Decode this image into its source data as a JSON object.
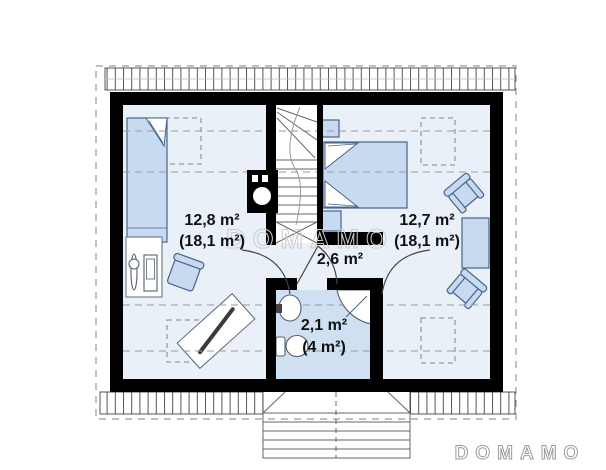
{
  "plan": {
    "title_watermark": "DOMAMO",
    "rooms": {
      "bedroom_left": {
        "area": "12,8 m²",
        "area_total": "(18,1 m²)"
      },
      "bedroom_right": {
        "area": "12,7 m²",
        "area_total": "(18,1 m²)"
      },
      "hall": {
        "area": "2,6 m²"
      },
      "bathroom": {
        "area": "2,1 m²",
        "area_total": "(4 m²)"
      }
    },
    "icons": {
      "chimney": "chimney-flue-icon",
      "stairs": "staircase-icon",
      "shower": "corner-shower-icon",
      "sink": "washbasin-icon",
      "toilet": "toilet-icon"
    }
  },
  "brand": {
    "logo_text": "DOMAMO"
  },
  "colors": {
    "wall": "#000000",
    "floor": "#eaf0f8",
    "bathroom_floor": "#cfe0f2",
    "furniture": "#c7daf0",
    "furniture_outline": "#46648c",
    "dashed": "#9a9a9a",
    "watermark": "#cccccc",
    "logo": "#9b9b9b",
    "text": "#111111"
  }
}
